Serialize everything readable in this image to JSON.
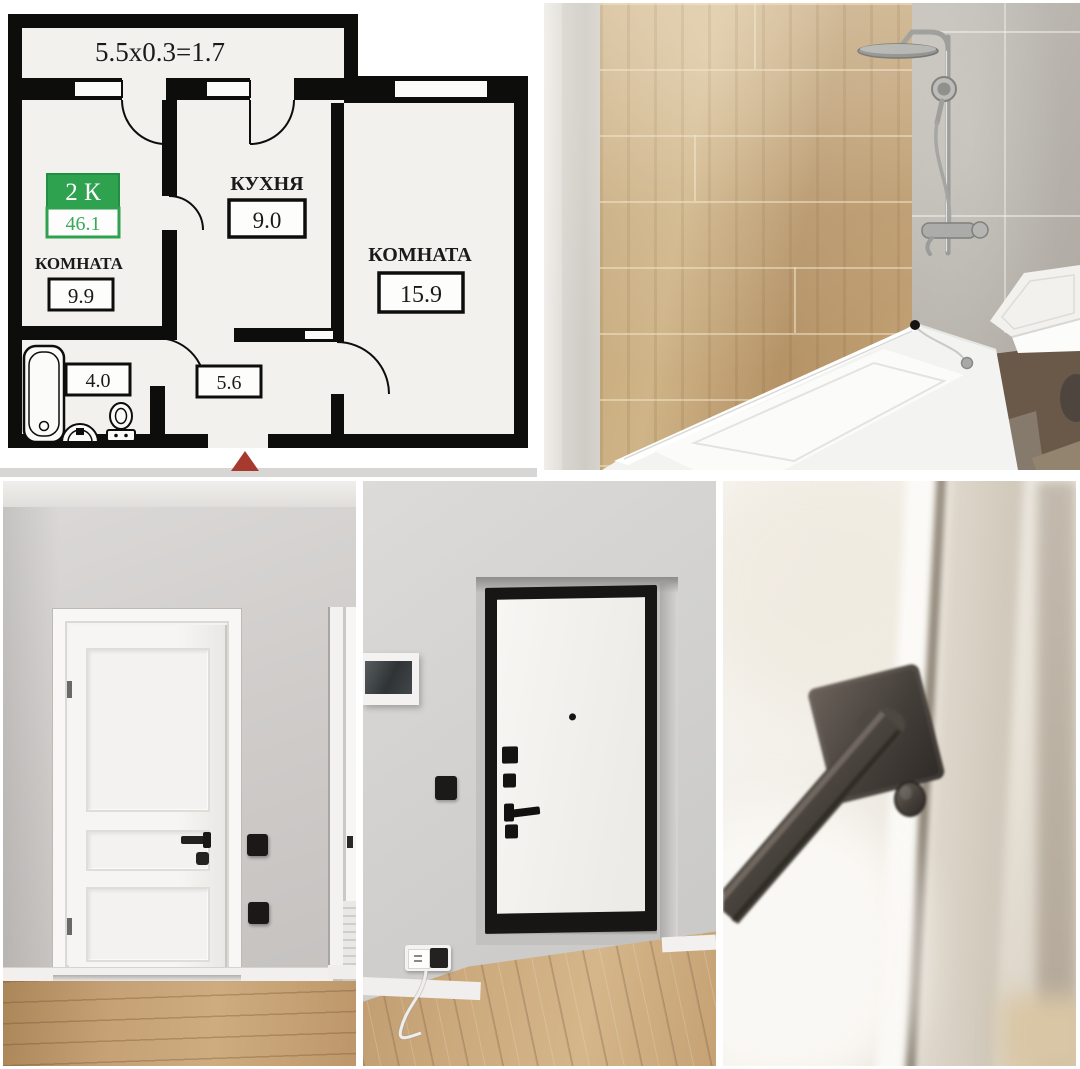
{
  "collage": {
    "background_color": "#ffffff",
    "panel_names": [
      "floor-plan",
      "bathroom-photo",
      "hallway-door-photo",
      "entrance-door-photo",
      "door-handle-closeup-photo"
    ]
  },
  "floor_plan": {
    "balcony_dimension_label": "5.5x0.3=1.7",
    "listing_badge": {
      "type_label": "2 К",
      "total_area": "46.1"
    },
    "rooms": [
      {
        "name": "КОМНАТА",
        "area": "9.9"
      },
      {
        "name": "КУХНЯ",
        "area": "9.0"
      },
      {
        "name": "КОМНАТА",
        "area": "15.9"
      }
    ],
    "bathroom": {
      "area": "4.0"
    },
    "hallway": {
      "area": "5.6"
    },
    "colors": {
      "badge_green": "#2ea24e",
      "badge_area_text_green": "#3aa85a",
      "entrance_arrow_red": "#a63a2e",
      "wall_black": "#0d0d0c",
      "plan_background": "#f2f1ee"
    }
  }
}
